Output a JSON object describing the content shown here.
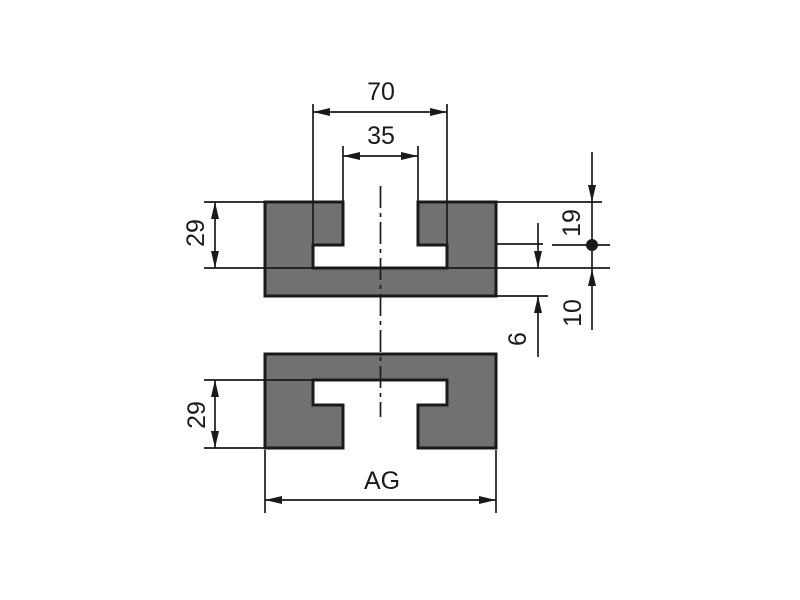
{
  "drawing": {
    "colors": {
      "profile_fill": "#717171",
      "line": "#1a1a1a",
      "background": "#ffffff"
    },
    "dimensions": {
      "cavity_width": "70",
      "mouth_width": "35",
      "upper_slot_depth": "29",
      "lip_depth": "19",
      "undercut_height": "10",
      "base_thickness": "6",
      "lower_slot_depth": "29",
      "overall_width": "AG"
    }
  }
}
